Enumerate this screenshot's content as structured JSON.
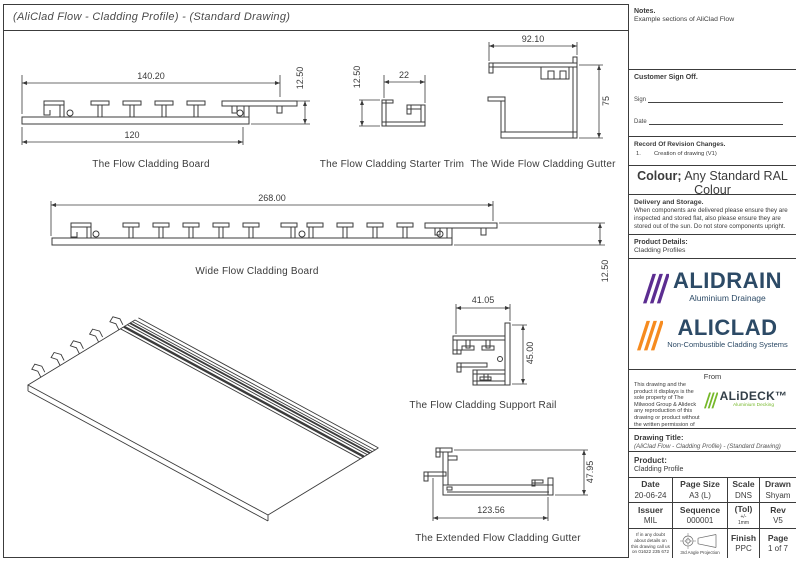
{
  "page": {
    "title": "(AliClad Flow - Cladding Profile) - (Standard Drawing)"
  },
  "colors": {
    "line": "#3b3b3b",
    "alidrain_purple": "#5c2d91",
    "aliclad_orange": "#f68b1f",
    "alideck_green": "#76b82a",
    "logo_navy": "#2c4a66"
  },
  "drawings": {
    "flow_board": {
      "caption": "The Flow Cladding Board",
      "dim_top": "140.20",
      "dim_bottom": "120",
      "dim_height": "12.50"
    },
    "starter_trim": {
      "caption": "The Flow Cladding Starter Trim",
      "dim_width": "22",
      "dim_height": "12.50"
    },
    "wide_gutter": {
      "caption": "The Wide Flow Cladding Gutter",
      "dim_width": "92.10",
      "dim_height": "75"
    },
    "wide_board": {
      "caption": "Wide Flow Cladding Board",
      "dim_width": "268.00",
      "dim_height": "12.50"
    },
    "support_rail": {
      "caption": "The Flow Cladding Support Rail",
      "dim_width": "41.05",
      "dim_height": "45.00"
    },
    "extended_gutter": {
      "caption": "The Extended Flow Cladding Gutter",
      "dim_width": "123.56",
      "dim_height": "47.95"
    }
  },
  "sidebar": {
    "notes": {
      "heading": "Notes.",
      "body": "Example sections of AliClad Flow"
    },
    "sign_off": {
      "heading": "Customer Sign Off.",
      "sign_label": "Sign",
      "date_label": "Date"
    },
    "revisions": {
      "heading": "Record Of Revision Changes.",
      "items": [
        {
          "num": "1.",
          "text": "Creation of drawing (V1)"
        }
      ]
    },
    "colour": {
      "heading": "Colour;",
      "value": "Any Standard RAL Colour"
    },
    "delivery": {
      "heading": "Delivery and Storage.",
      "body": "When components are delivered please ensure they are inspected and stored flat, also please ensure they are stored out of the sun. Do not store components upright."
    },
    "product_details": {
      "heading": "Product Details:",
      "value": "Cladding Profiles"
    },
    "logos": {
      "alidrain": {
        "name": "ALIDRAIN",
        "tagline": "Aluminium Drainage"
      },
      "aliclad": {
        "name": "ALICLAD",
        "tagline": "Non-Combustible Cladding Systems"
      },
      "from_label": "From",
      "alideck": {
        "name": "ALiDECK™",
        "tagline": "Aluminium Decking"
      }
    },
    "legal": "This drawing and the product it displays is the sole property of The Milwood Group & Alideck any reproduction of this drawing or product without the written permission of The Milwood Group & Alideck is prohibited.",
    "drawing_title": {
      "heading": "Drawing Title:",
      "value": "(AliClad Flow - Cladding Profile) - (Standard Drawing)"
    },
    "product": {
      "heading": "Product:",
      "value": "Cladding Profile"
    },
    "table": {
      "rows": [
        [
          {
            "label": "Date",
            "value": "20-06-24"
          },
          {
            "label": "Page Size",
            "value": "A3 (L)"
          },
          {
            "label": "Scale",
            "value": "DNS"
          },
          {
            "label": "Drawn",
            "value": "Shyam"
          }
        ],
        [
          {
            "label": "Issuer",
            "value": "MIL"
          },
          {
            "label": "Sequence",
            "value": "000001"
          },
          {
            "label": "(Tol)",
            "value": "+/- 1mm"
          },
          {
            "label": "Rev",
            "value": "V5"
          }
        ]
      ],
      "doubt_note": "If in any doubt about details on this drawing call us on 01622 235 672",
      "projection_label": "3rd Angle Projection",
      "finish": {
        "label": "Finish",
        "value": "PPC"
      },
      "page_cell": {
        "label": "Page",
        "value": "1 of 7"
      }
    }
  }
}
